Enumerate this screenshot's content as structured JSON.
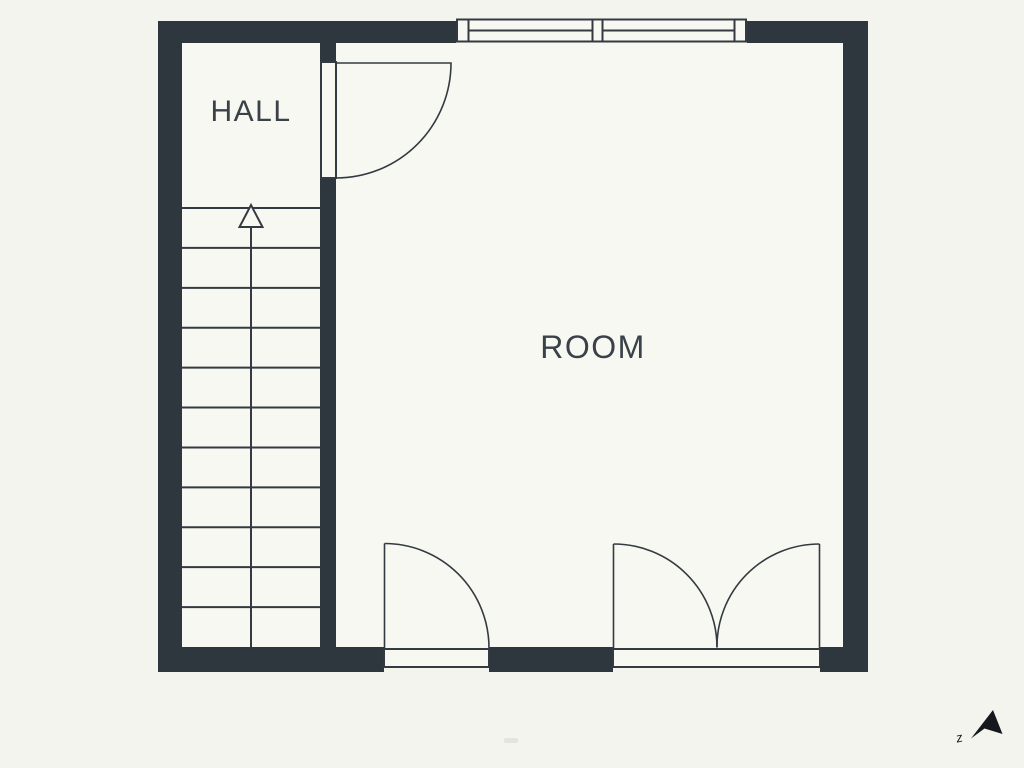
{
  "colors": {
    "background": "#f4f4ee",
    "floor": "#f8f8f2",
    "wall": "#2e363e",
    "line": "#333a41",
    "label": "#3a4148"
  },
  "floorplan": {
    "hall": {
      "label": "HALL"
    },
    "room": {
      "label": "ROOM"
    },
    "stairs": {
      "steps": 11,
      "direction": "up-arrow"
    },
    "window": {
      "panes": 2
    },
    "doors": [
      {
        "id": "hall-to-room",
        "type": "single-swing",
        "location": "interior-wall-top"
      },
      {
        "id": "bottom-left",
        "type": "single-swing",
        "location": "bottom-wall"
      },
      {
        "id": "bottom-right",
        "type": "double-swing",
        "location": "bottom-wall"
      }
    ],
    "compass": {
      "letter": "z",
      "icon": "north-arrow-icon"
    }
  }
}
